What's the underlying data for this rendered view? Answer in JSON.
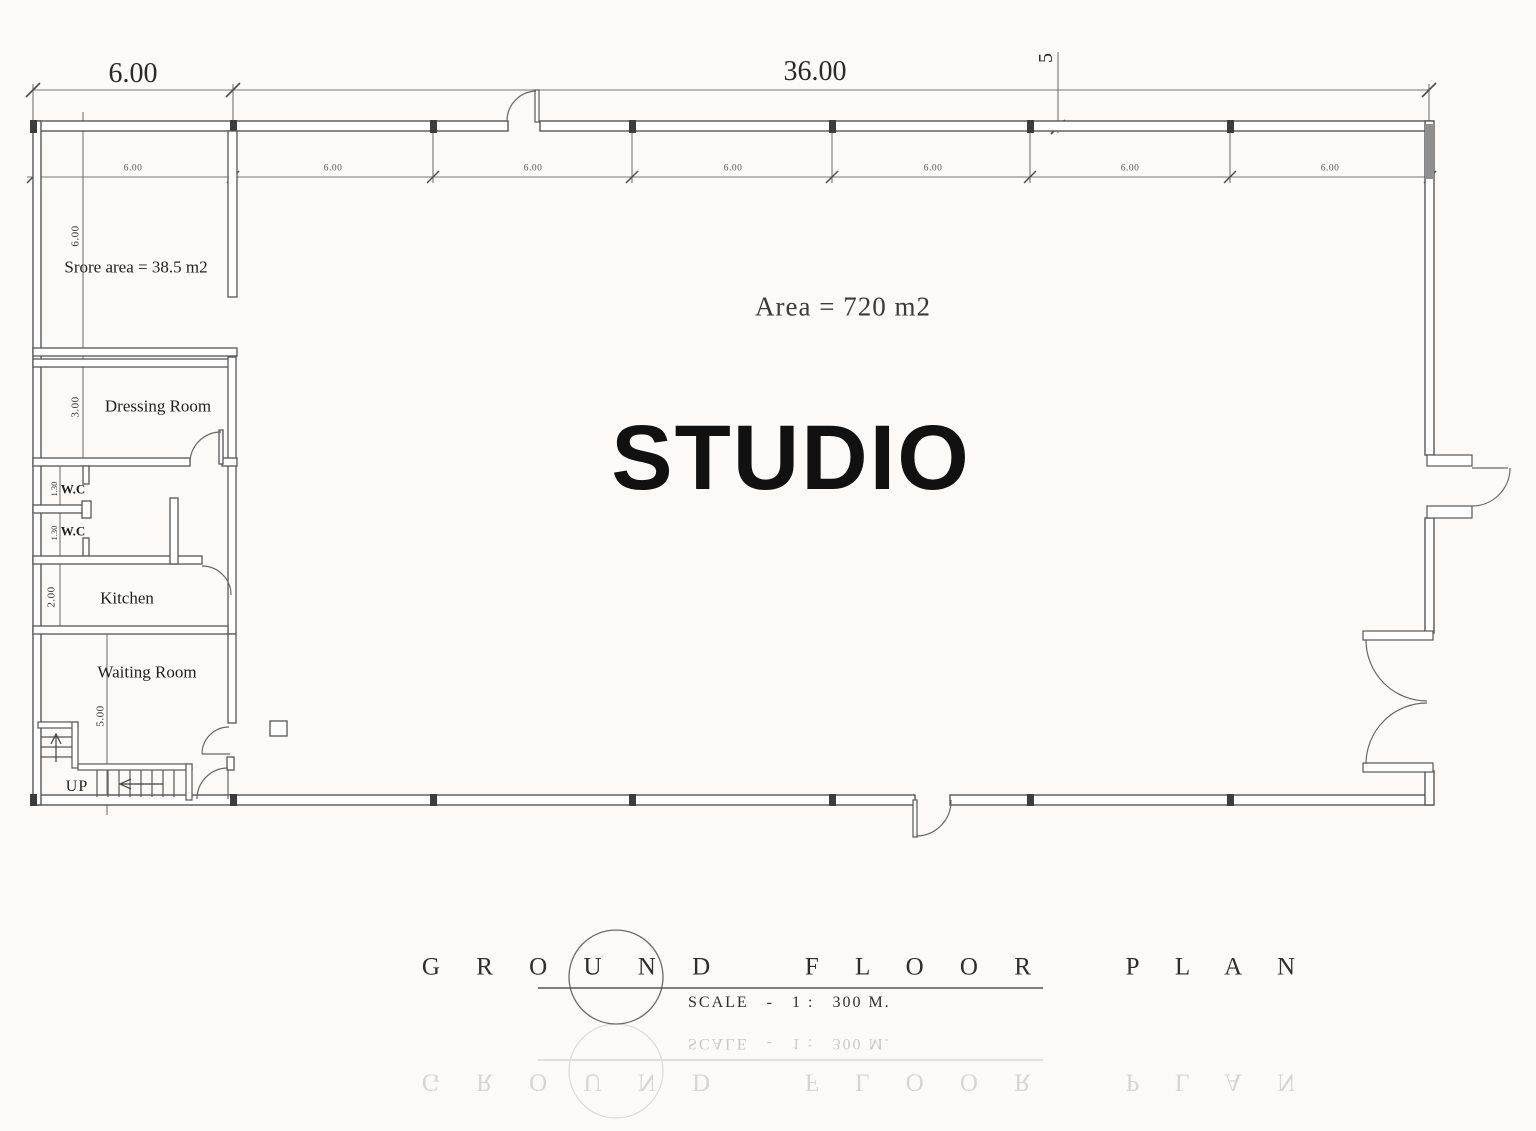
{
  "colors": {
    "wall_line": "#565656",
    "dim_line": "#767676",
    "hatch": "#8f8f8f",
    "text": "#1f1f1f",
    "background": "#fbfaf8"
  },
  "dimensions": {
    "top_left": "6.00",
    "top_main": "36.00",
    "grid_marker": "5",
    "bays": [
      "6.00",
      "6.00",
      "6.00",
      "6.00",
      "6.00",
      "6.00",
      "6.00"
    ],
    "store_height": "6.00",
    "dressing_height": "3.00",
    "wc1_height": "1.30",
    "wc2_height": "1.30",
    "kitchen_height": "2.00",
    "waiting_height": "5.00"
  },
  "rooms": {
    "store": "Srore area = 38.5 m2",
    "dressing": "Dressing Room",
    "wc1": "W.C",
    "wc2": "W.C",
    "kitchen": "Kitchen",
    "waiting": "Waiting Room",
    "stairs_up": "UP"
  },
  "studio": {
    "area": "Area = 720 m2",
    "name": "STUDIO"
  },
  "title_block": {
    "title": "G R O U N D   F L O O R   P L A N",
    "scale": "SCALE   -   1 :   300 M."
  }
}
